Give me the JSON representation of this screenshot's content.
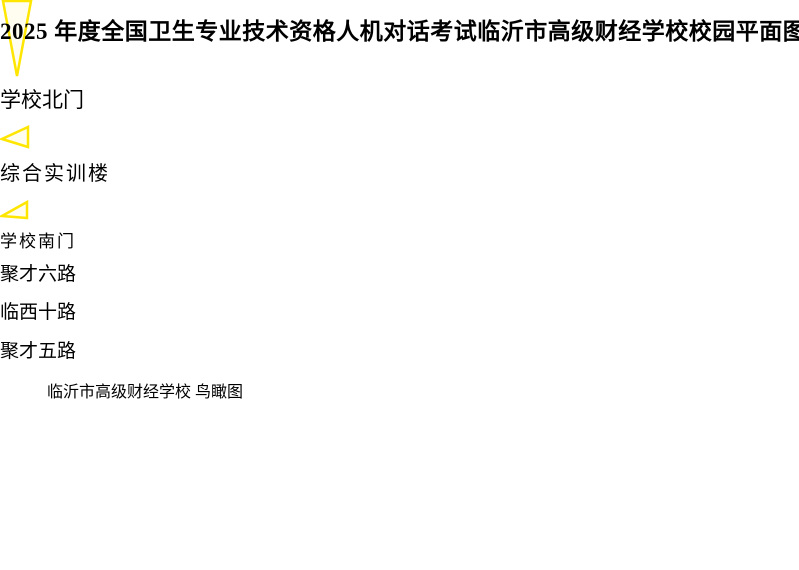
{
  "title": "2025 年度全国卫生专业技术资格人机对话考试临沂市高级财经学校校园平面图",
  "map": {
    "callouts": {
      "north_gate": "学校北门",
      "training_building": "综合实训楼",
      "south_gate": "学校南门"
    },
    "road_labels": {
      "north": "聚才六路",
      "west": "临西十路",
      "south": "聚才五路"
    },
    "watermark": "临沂市高级财经学校  鸟瞰图",
    "colors": {
      "callout_border": "#ffe600",
      "callout_text": "#ee0000",
      "road_label_background": "#ffffff",
      "road_label_border": "#000000",
      "watermark_text": "#ff9400",
      "track": "#c2664d",
      "sports_field": "#6fae49",
      "flag": "#e01818"
    }
  }
}
